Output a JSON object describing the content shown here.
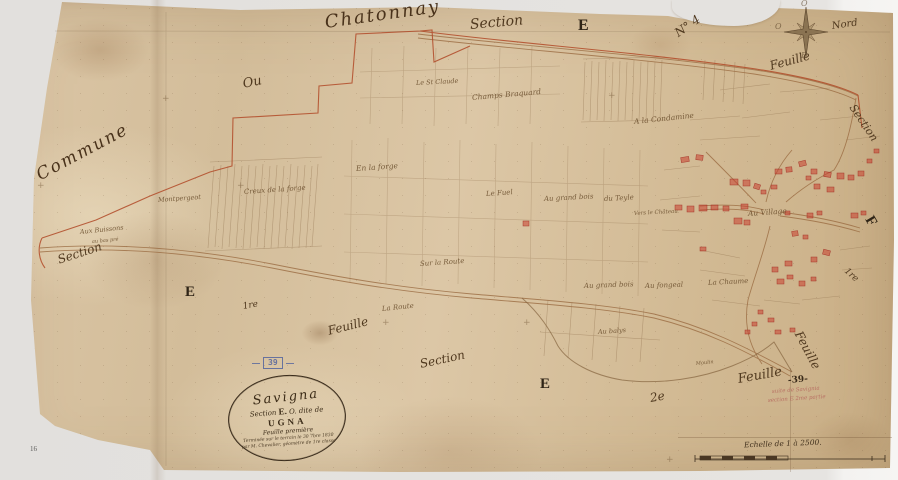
{
  "map": {
    "colors": {
      "paper": "#d6bf9d",
      "ink": "#4a3723",
      "boundary_red": "#b14a28",
      "building_red": "#c0392b",
      "stamp_blue": "#54659e",
      "pencil_red": "#b4645c",
      "background": "#e6e4e1"
    },
    "cartouche": {
      "line1": "Savigna",
      "line2_pre": "Section",
      "line2_letter": "E.",
      "line2_post": "O. dite de",
      "line3": "UGNA",
      "line4": "Feuille première",
      "line5": "Terminée sur le terrain le 30 7bre 1830",
      "line6": "par M. Chevalier, géomètre de 1re classe"
    },
    "stamp": {
      "number": "39"
    },
    "scale": {
      "text": "Echelle de 1 à 2500."
    },
    "labels": [
      {
        "name": "label-chatonnay",
        "text": "Chatonnay",
        "x": 325,
        "y": 14,
        "size": 18,
        "rot": -8,
        "cls": "xl"
      },
      {
        "name": "label-section-top",
        "text": "Section",
        "x": 470,
        "y": 18,
        "size": 14,
        "rot": -5
      },
      {
        "name": "label-e-top",
        "text": "E",
        "x": 578,
        "y": 18,
        "size": 16,
        "rot": 0,
        "cls": "bold"
      },
      {
        "name": "label-no4",
        "text": "N° 4",
        "x": 676,
        "y": 28,
        "size": 12,
        "rot": -35
      },
      {
        "name": "compass-north-label",
        "text": "Nord",
        "x": 832,
        "y": 22,
        "size": 10,
        "rot": -8
      },
      {
        "name": "compass-letter-west",
        "text": "O",
        "x": 775,
        "y": 23,
        "size": 8,
        "rot": 0,
        "cls": "faint"
      },
      {
        "name": "compass-letter-top",
        "text": "O",
        "x": 801,
        "y": 0,
        "size": 8,
        "rot": 0,
        "cls": "faint"
      },
      {
        "name": "compass-letter-bottom",
        "text": "E",
        "x": 801,
        "y": 52,
        "size": 8,
        "rot": 0,
        "cls": "faint"
      },
      {
        "name": "label-feuille-compass",
        "text": "Feuille",
        "x": 770,
        "y": 60,
        "size": 12,
        "rot": -15
      },
      {
        "name": "label-section-right",
        "text": "Section",
        "x": 852,
        "y": 100,
        "size": 11,
        "rot": 56
      },
      {
        "name": "label-f-right",
        "text": "F",
        "x": 868,
        "y": 210,
        "size": 15,
        "rot": 60,
        "cls": "bold"
      },
      {
        "name": "label-1re-right",
        "text": "1re",
        "x": 845,
        "y": 266,
        "size": 9,
        "rot": 42
      },
      {
        "name": "label-commune",
        "text": "Commune",
        "x": 38,
        "y": 168,
        "size": 17,
        "rot": -28,
        "cls": "xl"
      },
      {
        "name": "label-section-left",
        "text": "Section",
        "x": 58,
        "y": 254,
        "size": 12,
        "rot": -18
      },
      {
        "name": "label-ou",
        "text": "Ou",
        "x": 243,
        "y": 78,
        "size": 13,
        "rot": -12
      },
      {
        "name": "label-e-left",
        "text": "E",
        "x": 185,
        "y": 285,
        "size": 15,
        "rot": 0,
        "cls": "bold"
      },
      {
        "name": "label-1re-left",
        "text": "1re",
        "x": 243,
        "y": 303,
        "size": 9,
        "rot": -10
      },
      {
        "name": "label-feuille-bottom-left",
        "text": "Feuille",
        "x": 328,
        "y": 325,
        "size": 12,
        "rot": -14
      },
      {
        "name": "label-section-bottom",
        "text": "Section",
        "x": 420,
        "y": 358,
        "size": 12,
        "rot": -12
      },
      {
        "name": "label-e-bottom",
        "text": "E",
        "x": 540,
        "y": 377,
        "size": 15,
        "rot": 0,
        "cls": "bold"
      },
      {
        "name": "label-2e",
        "text": "2e",
        "x": 650,
        "y": 392,
        "size": 12,
        "rot": -10
      },
      {
        "name": "label-feuille-right-diag",
        "text": "Feuille",
        "x": 798,
        "y": 326,
        "size": 12,
        "rot": 62
      },
      {
        "name": "label-feuille-39",
        "text": "Feuille",
        "x": 738,
        "y": 373,
        "size": 13,
        "rot": -10
      },
      {
        "name": "label-39-ink",
        "text": "-39-",
        "x": 788,
        "y": 377,
        "size": 9,
        "rot": -5,
        "cls": "bold-sm"
      },
      {
        "name": "label-pencil-note-1",
        "text": "suite de Savignia",
        "x": 772,
        "y": 390,
        "size": 5.5,
        "rot": -4,
        "cls": "pencil"
      },
      {
        "name": "label-pencil-note-2",
        "text": "section E 2me partie",
        "x": 768,
        "y": 399,
        "size": 5.5,
        "rot": -4,
        "cls": "pencil"
      },
      {
        "name": "label-montpergeot",
        "text": "Montpergeot",
        "x": 158,
        "y": 197,
        "size": 6.5,
        "rot": -4,
        "cls": "sm"
      },
      {
        "name": "label-aux-buissons",
        "text": "Aux Buissons",
        "x": 80,
        "y": 229,
        "size": 6.5,
        "rot": -6,
        "cls": "sm"
      },
      {
        "name": "label-au-bas-pre",
        "text": "au bas pré",
        "x": 92,
        "y": 240,
        "size": 5,
        "rot": -5,
        "cls": "sm"
      },
      {
        "name": "label-creux-de-la-forge",
        "text": "Creux de la forge",
        "x": 244,
        "y": 189,
        "size": 7,
        "rot": -4,
        "cls": "sm"
      },
      {
        "name": "label-en-la-forge",
        "text": "En la forge",
        "x": 356,
        "y": 165,
        "size": 7.5,
        "rot": -4,
        "cls": "sm"
      },
      {
        "name": "label-st-claude",
        "text": "Le St Claude",
        "x": 416,
        "y": 80,
        "size": 6.5,
        "rot": -3,
        "cls": "sm"
      },
      {
        "name": "label-champs-braquard",
        "text": "Champs Braquard",
        "x": 472,
        "y": 94,
        "size": 7.5,
        "rot": -5,
        "cls": "sm"
      },
      {
        "name": "label-condamine",
        "text": "A la Condamine",
        "x": 634,
        "y": 118,
        "size": 7.5,
        "rot": -6,
        "cls": "sm"
      },
      {
        "name": "label-le-fuel",
        "text": "Le Fuel",
        "x": 486,
        "y": 191,
        "size": 7,
        "rot": -4,
        "cls": "sm"
      },
      {
        "name": "label-grand-bois-1",
        "text": "Au grand bois",
        "x": 544,
        "y": 196,
        "size": 7,
        "rot": -3,
        "cls": "sm"
      },
      {
        "name": "label-du-teyle",
        "text": "du Teyle",
        "x": 604,
        "y": 196,
        "size": 7,
        "rot": -3,
        "cls": "sm"
      },
      {
        "name": "label-vers-chateau",
        "text": "Vers le Château",
        "x": 634,
        "y": 212,
        "size": 5.5,
        "rot": -3,
        "cls": "sm"
      },
      {
        "name": "label-sur-la-route",
        "text": "Sur la Route",
        "x": 420,
        "y": 261,
        "size": 7,
        "rot": -4,
        "cls": "sm"
      },
      {
        "name": "label-la-route",
        "text": "La Route",
        "x": 382,
        "y": 306,
        "size": 7,
        "rot": -6,
        "cls": "sm"
      },
      {
        "name": "label-grand-bois-2",
        "text": "Au grand bois",
        "x": 584,
        "y": 283,
        "size": 7,
        "rot": -2,
        "cls": "sm"
      },
      {
        "name": "label-au-fongeal",
        "text": "Au fongeal",
        "x": 645,
        "y": 283,
        "size": 7,
        "rot": -2,
        "cls": "sm"
      },
      {
        "name": "label-la-chaume",
        "text": "La Chaume",
        "x": 708,
        "y": 280,
        "size": 7,
        "rot": -3,
        "cls": "sm"
      },
      {
        "name": "label-au-balys",
        "text": "Au balys",
        "x": 598,
        "y": 329,
        "size": 6.5,
        "rot": -4,
        "cls": "sm"
      },
      {
        "name": "label-moulin",
        "text": "Moulin",
        "x": 696,
        "y": 362,
        "size": 5,
        "rot": -6,
        "cls": "sm"
      },
      {
        "name": "label-au-village",
        "text": "Au Village",
        "x": 748,
        "y": 210,
        "size": 7.5,
        "rot": -4,
        "cls": "sm"
      },
      {
        "name": "label-page-16",
        "text": "16",
        "x": 30,
        "y": 446,
        "size": 7,
        "rot": 0,
        "cls": "page-num"
      }
    ],
    "crosses": [
      {
        "x": 37,
        "y": 182
      },
      {
        "x": 237,
        "y": 182
      },
      {
        "x": 382,
        "y": 319
      },
      {
        "x": 523,
        "y": 319
      },
      {
        "x": 608,
        "y": 92
      },
      {
        "x": 162,
        "y": 95
      },
      {
        "x": 666,
        "y": 456
      }
    ],
    "buildings": [
      [
        681,
        157,
        8,
        5,
        -8
      ],
      [
        696,
        155,
        7,
        5,
        6
      ],
      [
        730,
        179,
        8,
        6,
        0
      ],
      [
        743,
        180,
        7,
        6,
        0
      ],
      [
        754,
        184,
        6,
        5,
        18
      ],
      [
        775,
        169,
        7,
        5,
        0
      ],
      [
        786,
        167,
        6,
        5,
        -5
      ],
      [
        799,
        161,
        7,
        5,
        -14
      ],
      [
        811,
        169,
        6,
        5,
        0
      ],
      [
        806,
        176,
        5,
        4,
        0
      ],
      [
        824,
        172,
        7,
        5,
        8
      ],
      [
        837,
        173,
        7,
        6,
        0
      ],
      [
        848,
        175,
        6,
        5,
        0
      ],
      [
        858,
        171,
        6,
        5,
        0
      ],
      [
        814,
        184,
        6,
        5,
        0
      ],
      [
        827,
        187,
        7,
        5,
        0
      ],
      [
        771,
        185,
        6,
        4,
        0
      ],
      [
        761,
        190,
        5,
        4,
        0
      ],
      [
        741,
        204,
        7,
        5,
        0
      ],
      [
        699,
        205,
        8,
        6,
        0
      ],
      [
        711,
        205,
        7,
        5,
        0
      ],
      [
        723,
        206,
        6,
        5,
        0
      ],
      [
        687,
        206,
        7,
        6,
        0
      ],
      [
        675,
        205,
        7,
        5,
        0
      ],
      [
        734,
        218,
        8,
        6,
        0
      ],
      [
        744,
        220,
        6,
        5,
        0
      ],
      [
        785,
        211,
        5,
        4,
        0
      ],
      [
        807,
        213,
        6,
        5,
        0
      ],
      [
        817,
        211,
        5,
        4,
        0
      ],
      [
        851,
        213,
        7,
        5,
        0
      ],
      [
        861,
        211,
        5,
        4,
        0
      ],
      [
        792,
        231,
        6,
        5,
        -8
      ],
      [
        803,
        235,
        5,
        4,
        0
      ],
      [
        823,
        250,
        7,
        5,
        14
      ],
      [
        811,
        257,
        6,
        5,
        0
      ],
      [
        785,
        261,
        7,
        5,
        0
      ],
      [
        772,
        267,
        6,
        5,
        0
      ],
      [
        787,
        275,
        6,
        4,
        0
      ],
      [
        777,
        279,
        7,
        5,
        0
      ],
      [
        799,
        281,
        6,
        5,
        0
      ],
      [
        811,
        277,
        5,
        4,
        0
      ],
      [
        867,
        159,
        5,
        4,
        0
      ],
      [
        874,
        149,
        5,
        4,
        0
      ],
      [
        523,
        221,
        6,
        5,
        0
      ],
      [
        700,
        247,
        6,
        4,
        0
      ],
      [
        758,
        310,
        5,
        4,
        0
      ],
      [
        768,
        318,
        6,
        4,
        0
      ],
      [
        752,
        322,
        5,
        4,
        0
      ],
      [
        745,
        330,
        5,
        4,
        0
      ],
      [
        775,
        330,
        6,
        4,
        0
      ],
      [
        790,
        328,
        5,
        4,
        0
      ]
    ]
  }
}
